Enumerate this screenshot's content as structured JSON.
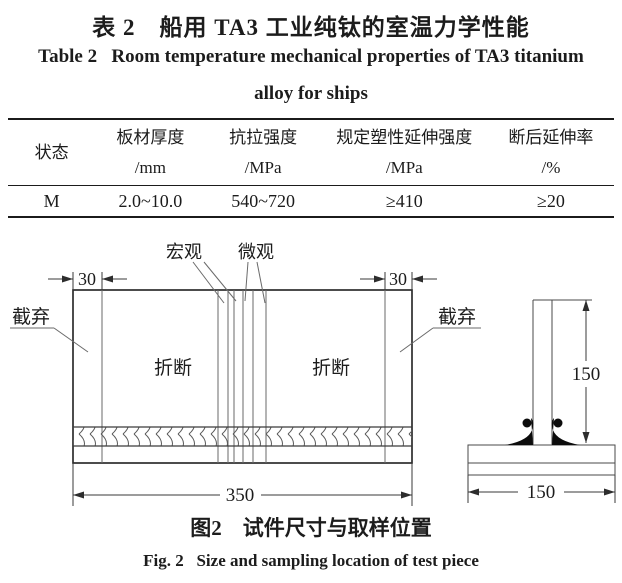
{
  "table": {
    "title_zh": "表 2　船用 TA3 工业纯钛的室温力学性能",
    "title_en_1": "Table 2   Room temperature mechanical properties of TA3 titanium",
    "title_en_2": "alloy for ships",
    "col1": {
      "name": "状态"
    },
    "col2": {
      "name": "板材厚度",
      "unit": "/mm"
    },
    "col3": {
      "name": "抗拉强度",
      "unit": "/MPa"
    },
    "col4": {
      "name": "规定塑性延伸强度",
      "unit": "/MPa"
    },
    "col5": {
      "name": "断后延伸率",
      "unit": "/%"
    },
    "row": {
      "state": "M",
      "thickness": "2.0~10.0",
      "tensile": "540~720",
      "proof": "≥410",
      "elongation": "≥20"
    }
  },
  "figure": {
    "labels": {
      "macro": "宏观",
      "micro": "微观",
      "discard": "截弃",
      "fracture": "折断"
    },
    "dims": {
      "edge30": "30",
      "length350": "350",
      "height150": "150",
      "width150": "150"
    },
    "caption_zh": "图2　试件尺寸与取样位置",
    "caption_en": "Fig. 2   Size and sampling location of test piece"
  }
}
